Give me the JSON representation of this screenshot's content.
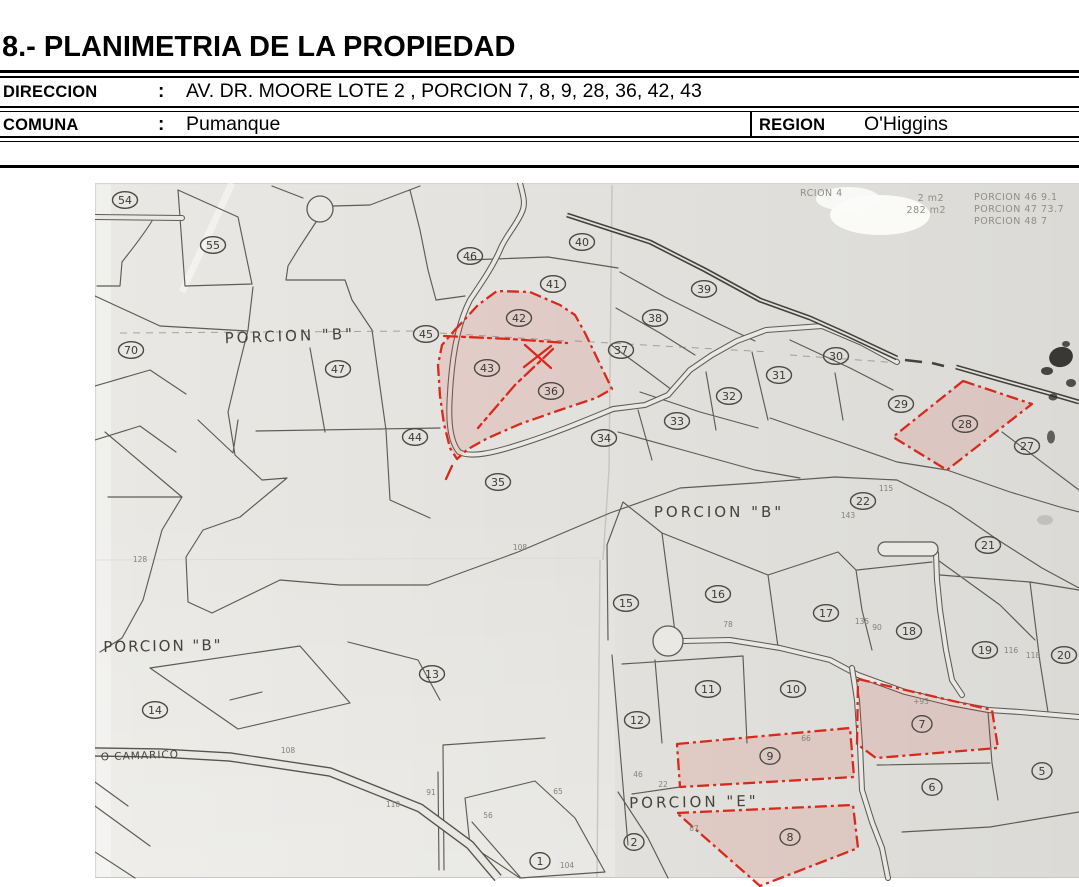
{
  "header": {
    "title": "8.- PLANIMETRIA DE LA PROPIEDAD",
    "rows": [
      {
        "label": "DIRECCION",
        "colon": ":",
        "value": "AV. DR. MOORE LOTE 2 , PORCION 7, 8, 9, 28, 36, 42, 43"
      },
      {
        "label": "COMUNA",
        "colon": ":",
        "value": "Pumanque",
        "label2": "REGION",
        "value2": "O'Higgins"
      }
    ]
  },
  "map": {
    "paper_color": "#e9e8e4",
    "ink_color": "#5d5b55",
    "highlight_color": "#d8291d",
    "parcels": [
      {
        "n": "54",
        "x": 125,
        "y": 200
      },
      {
        "n": "55",
        "x": 213,
        "y": 245
      },
      {
        "n": "70",
        "x": 131,
        "y": 350
      },
      {
        "n": "46",
        "x": 470,
        "y": 256
      },
      {
        "n": "40",
        "x": 582,
        "y": 242
      },
      {
        "n": "41",
        "x": 553,
        "y": 284
      },
      {
        "n": "39",
        "x": 704,
        "y": 289
      },
      {
        "n": "38",
        "x": 655,
        "y": 318
      },
      {
        "n": "42",
        "x": 519,
        "y": 318,
        "hl": true
      },
      {
        "n": "37",
        "x": 621,
        "y": 350
      },
      {
        "n": "45",
        "x": 426,
        "y": 334
      },
      {
        "n": "47",
        "x": 338,
        "y": 369
      },
      {
        "n": "43",
        "x": 487,
        "y": 368,
        "hl": true
      },
      {
        "n": "36",
        "x": 551,
        "y": 391,
        "hl": true
      },
      {
        "n": "31",
        "x": 779,
        "y": 375
      },
      {
        "n": "30",
        "x": 836,
        "y": 356
      },
      {
        "n": "29",
        "x": 901,
        "y": 404
      },
      {
        "n": "28",
        "x": 965,
        "y": 424,
        "hl": true
      },
      {
        "n": "27",
        "x": 1027,
        "y": 446
      },
      {
        "n": "44",
        "x": 415,
        "y": 437
      },
      {
        "n": "34",
        "x": 604,
        "y": 438
      },
      {
        "n": "33",
        "x": 677,
        "y": 421
      },
      {
        "n": "32",
        "x": 729,
        "y": 396
      },
      {
        "n": "35",
        "x": 498,
        "y": 482
      },
      {
        "n": "22",
        "x": 863,
        "y": 501
      },
      {
        "n": "21",
        "x": 988,
        "y": 545
      },
      {
        "n": "15",
        "x": 626,
        "y": 603
      },
      {
        "n": "16",
        "x": 718,
        "y": 594
      },
      {
        "n": "17",
        "x": 826,
        "y": 613
      },
      {
        "n": "18",
        "x": 909,
        "y": 631
      },
      {
        "n": "19",
        "x": 985,
        "y": 650
      },
      {
        "n": "20",
        "x": 1064,
        "y": 655
      },
      {
        "n": "13",
        "x": 432,
        "y": 674
      },
      {
        "n": "14",
        "x": 155,
        "y": 710
      },
      {
        "n": "12",
        "x": 637,
        "y": 720
      },
      {
        "n": "11",
        "x": 708,
        "y": 689
      },
      {
        "n": "10",
        "x": 793,
        "y": 689
      },
      {
        "n": "9",
        "x": 770,
        "y": 756,
        "hl": true
      },
      {
        "n": "7",
        "x": 922,
        "y": 724,
        "hl": true
      },
      {
        "n": "6",
        "x": 932,
        "y": 787
      },
      {
        "n": "5",
        "x": 1042,
        "y": 771
      },
      {
        "n": "8",
        "x": 790,
        "y": 837,
        "hl": true
      },
      {
        "n": "2",
        "x": 634,
        "y": 842
      },
      {
        "n": "1",
        "x": 540,
        "y": 861
      }
    ],
    "area_labels": [
      {
        "t": "PORCION \"B\"",
        "x": 290,
        "y": 341,
        "s": 15,
        "ls": 3,
        "r": -2
      },
      {
        "t": "PORCION \"B\"",
        "x": 719,
        "y": 517,
        "s": 15,
        "ls": 3,
        "r": 0
      },
      {
        "t": "PORCION \"B\"",
        "x": 163,
        "y": 651,
        "s": 15,
        "ls": 2,
        "r": -1
      },
      {
        "t": "PORCION \"E\"",
        "x": 694,
        "y": 807,
        "s": 15,
        "ls": 3,
        "r": -1
      }
    ],
    "road_label": {
      "t": "O CAMARICO",
      "x": 140,
      "y": 759,
      "s": 10.5,
      "ls": 1,
      "r": -2
    },
    "corner_notes": [
      {
        "t": "RCION 4",
        "x": 800,
        "y": 196,
        "a": "start"
      },
      {
        "t": "2 m2",
        "x": 944,
        "y": 201,
        "a": "end"
      },
      {
        "t": "282 m2",
        "x": 946,
        "y": 213,
        "a": "end"
      },
      {
        "t": "PORCION 46  9.1",
        "x": 974,
        "y": 200,
        "a": "start"
      },
      {
        "t": "PORCION 47  73.7",
        "x": 974,
        "y": 212,
        "a": "start"
      },
      {
        "t": "PORCION 48   7",
        "x": 974,
        "y": 224,
        "a": "start"
      }
    ],
    "small_numbers": [
      {
        "t": "108",
        "x": 288,
        "y": 753
      },
      {
        "t": "110",
        "x": 393,
        "y": 807
      },
      {
        "t": "108",
        "x": 520,
        "y": 550
      },
      {
        "t": "116",
        "x": 1011,
        "y": 653
      },
      {
        "t": "118",
        "x": 1033,
        "y": 658
      },
      {
        "t": "91",
        "x": 431,
        "y": 795
      },
      {
        "t": "104",
        "x": 567,
        "y": 868
      },
      {
        "t": "135",
        "x": 862,
        "y": 624
      },
      {
        "t": "90",
        "x": 877,
        "y": 630
      },
      {
        "t": "115",
        "x": 886,
        "y": 491
      },
      {
        "t": "143",
        "x": 848,
        "y": 518
      },
      {
        "t": "+93",
        "x": 921,
        "y": 704
      },
      {
        "t": "128",
        "x": 140,
        "y": 562
      },
      {
        "t": "87",
        "x": 694,
        "y": 831
      },
      {
        "t": "66",
        "x": 806,
        "y": 741
      },
      {
        "t": "78",
        "x": 728,
        "y": 627
      },
      {
        "t": "46",
        "x": 638,
        "y": 777
      },
      {
        "t": "22",
        "x": 663,
        "y": 787
      },
      {
        "t": "56",
        "x": 488,
        "y": 818
      },
      {
        "t": "65",
        "x": 558,
        "y": 794
      }
    ]
  }
}
